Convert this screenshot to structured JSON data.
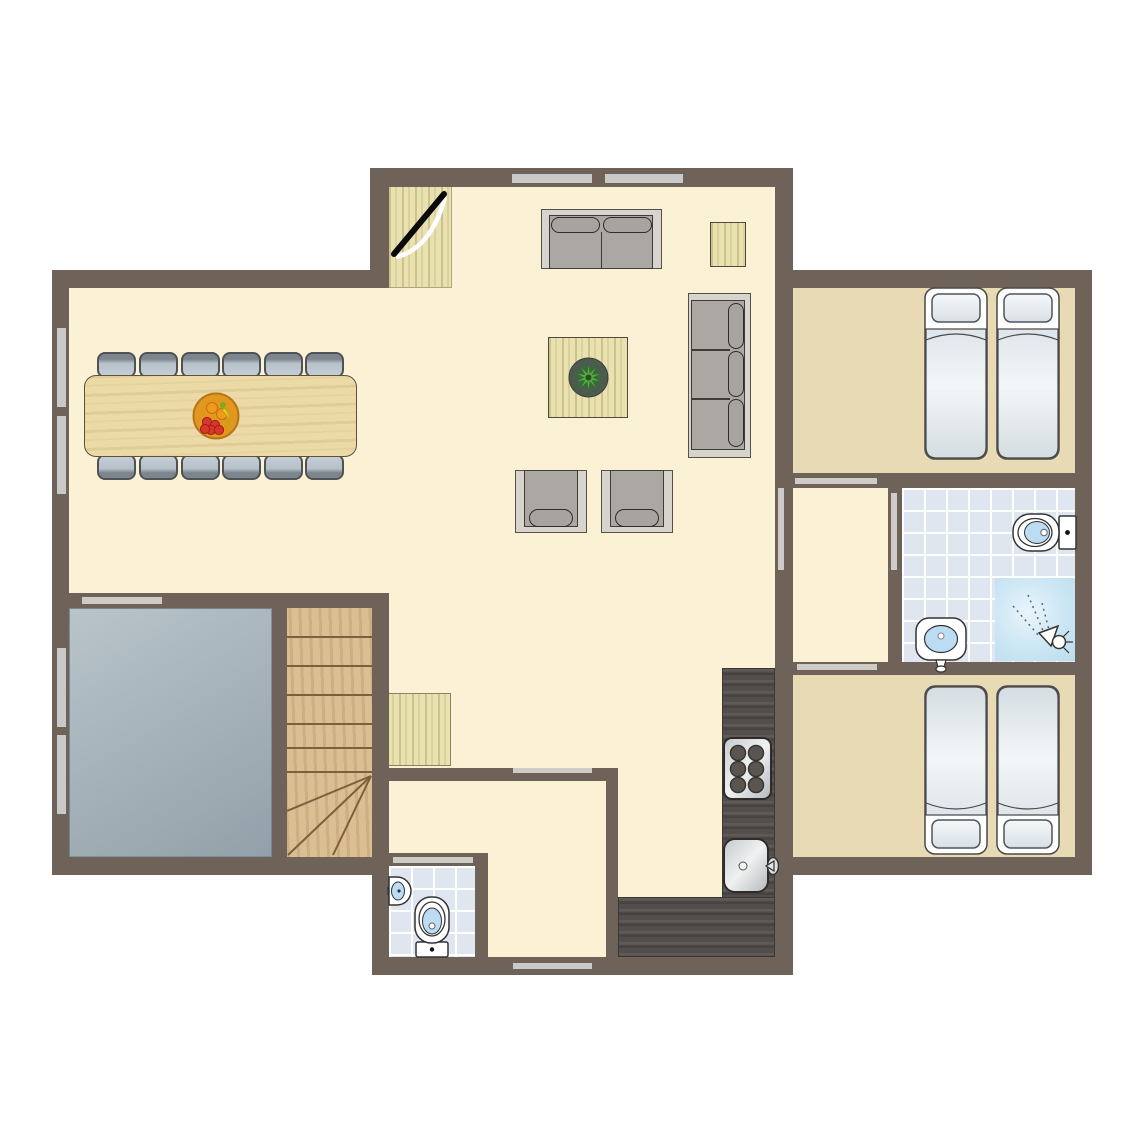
{
  "title": "Holiday home ground floor plan",
  "palette": {
    "wall": "#6E6259",
    "floor": "#FBF1D4",
    "bedroom-floor": "#E8DAB4",
    "tile": "#DFE6F0",
    "tile-grid": "#FFFFFF",
    "window": "#C9C9C9",
    "door-marker": "#CFCBC6",
    "wood-light": "#EAE1B0",
    "table-wood": "#ECDAA6",
    "stairs-wood": "#DCBE93",
    "stairs-line": "#7E5F3C",
    "counter": "#534E4B",
    "storage-from": "#B9C4CA",
    "storage-to": "#92A1A9",
    "sofa-frame": "#D7D4CE",
    "sofa-body": "#ABA7A2",
    "sofa-edge": "#3F3B38",
    "chair-seat": "#B6C0C8",
    "chair-back": "#7E868D",
    "chair-edge": "#4E5357",
    "basin": "#BBDCF2",
    "fixture": "#333333",
    "shower-from": "#EAF5FB",
    "shower-to": "#BCDDEE",
    "bed-frame": "#FFFFFF",
    "bed-edge": "#4A4A4A",
    "plant-dark": "#2F7030",
    "plant-light": "#5AA743",
    "bowl": "#E2971E",
    "fruit-red": "#D8352B",
    "fruit-orange": "#EF9A1E",
    "fruit-yellow": "#F2CF2A"
  },
  "rooms": [
    {
      "name": "living-dining-room",
      "floor": "cream"
    },
    {
      "name": "kitchen",
      "floor": "cream"
    },
    {
      "name": "hall",
      "floor": "cream"
    },
    {
      "name": "wc",
      "floor": "tiles"
    },
    {
      "name": "storage-room",
      "floor": "gray"
    },
    {
      "name": "staircase",
      "floor": "wood"
    },
    {
      "name": "anteroom",
      "floor": "cream"
    },
    {
      "name": "bathroom",
      "floor": "tiles"
    },
    {
      "name": "bedroom-1",
      "floor": "tan"
    },
    {
      "name": "bedroom-2",
      "floor": "tan"
    }
  ],
  "inventory": {
    "dining_chairs": 12,
    "dining_tables": 1,
    "fruit_bowls": 1,
    "sofas_two_seat": 1,
    "sofas_three_seat": 1,
    "armchairs": 2,
    "coffee_tables": 1,
    "side_tables": 1,
    "plants": 1,
    "beds": 4,
    "toilets": 2,
    "wash_basins": 3,
    "showers": 1,
    "stove_burners": 6,
    "kitchen_sinks": 1,
    "windows": 7,
    "door_openings": 7,
    "entrance_doors": 1,
    "door_mats": 2
  }
}
